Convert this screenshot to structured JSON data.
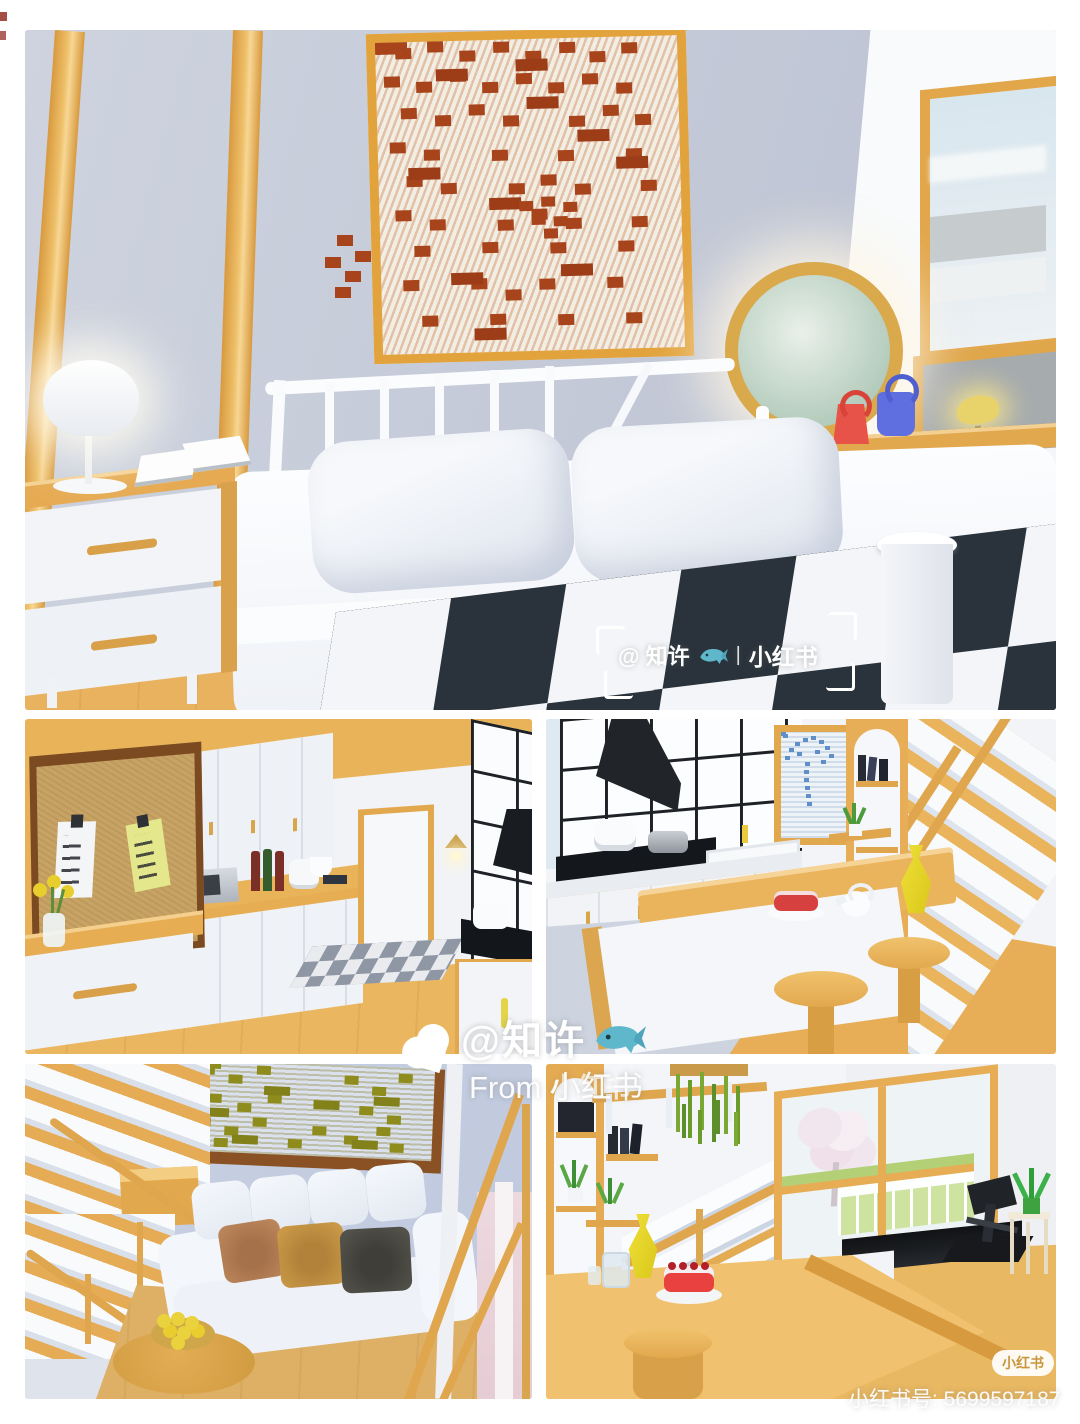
{
  "watermark_top": {
    "handle": "@ 知许",
    "separator": "|",
    "brand": "小红书"
  },
  "watermark_center": {
    "handle": "@知许",
    "from": "From 小红书"
  },
  "watermark_corner": {
    "badge": "小红书",
    "account": "小红书号: 5699597187"
  },
  "watermark_panel5": {
    "brand": "小红书"
  },
  "palette": {
    "wood": "#e2a84e",
    "wood_light": "#f0c26c",
    "wall_gray_blue": "#c5cbd9",
    "wall_blue": "#c3cce0",
    "blanket_dark": "#2a333b",
    "cork": "#c7a365",
    "frame_brown": "#7c4a20",
    "pixel_rust": "#a8441b",
    "pixel_olive": "#8e8c1d",
    "palm_blue": "#5e8fc6",
    "grass_green": "#9ec63e",
    "bag_red": "#e85349",
    "bag_blue": "#5f6fe0",
    "vase_yellow": "#e8d627",
    "whale_teal": "#5fb7cc",
    "badge_text": "#c8963c"
  }
}
